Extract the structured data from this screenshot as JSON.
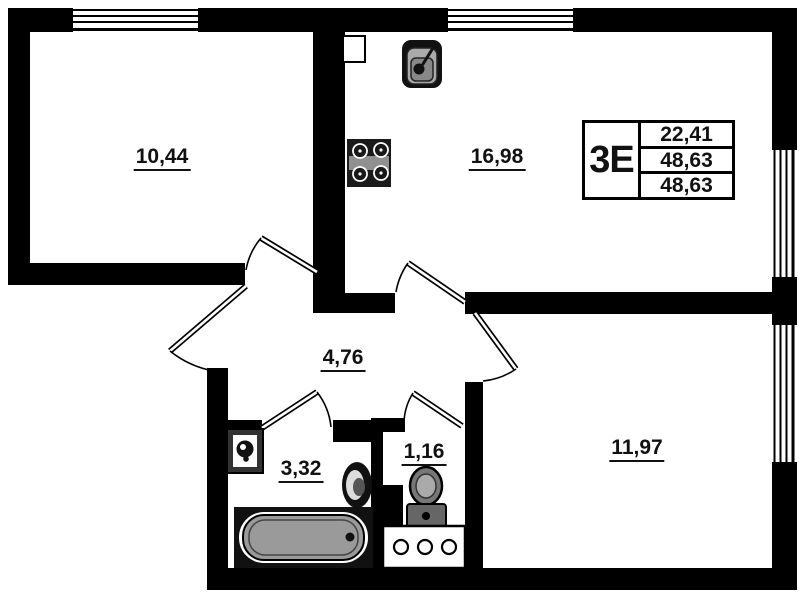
{
  "rooms": {
    "bedroom": {
      "area": "10,44"
    },
    "kitchen_living": {
      "area": "16,98"
    },
    "hallway": {
      "area": "4,76"
    },
    "bathroom": {
      "area": "3,32"
    },
    "wc": {
      "area": "1,16"
    },
    "bedroom2": {
      "area": "11,97"
    }
  },
  "info_table": {
    "unit_type": "3E",
    "values": [
      "22,41",
      "48,63",
      "48,63"
    ]
  },
  "icons": [
    "window-icon",
    "door-icon",
    "kitchen-sink-icon",
    "stove-icon",
    "washing-machine-icon",
    "bathroom-sink-icon",
    "bathtub-icon",
    "toilet-icon",
    "vanity-cabinet-icon"
  ],
  "colors": {
    "wall": "#000000",
    "background": "#ffffff",
    "bathtub_fill": "#9a9a9a",
    "appliance_dark": "#1a1a1a"
  }
}
